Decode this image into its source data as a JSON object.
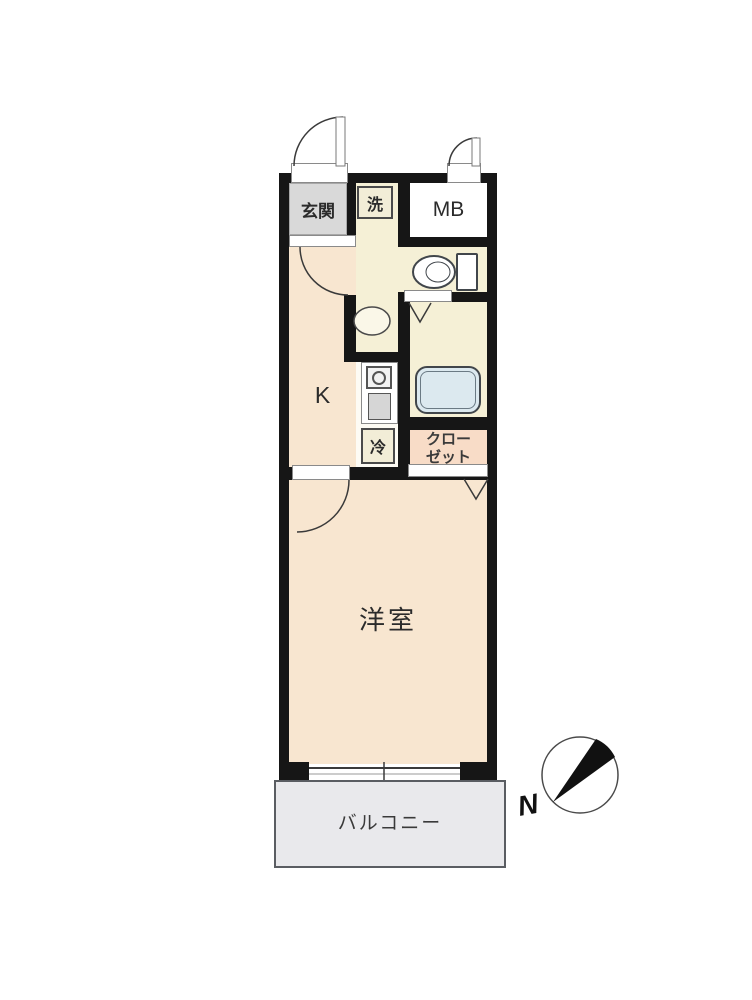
{
  "floorplan": {
    "type": "apartment-1K-floor-plan",
    "rooms": {
      "genkan": {
        "label": "玄関"
      },
      "laundry": {
        "label": "洗"
      },
      "meter_box": {
        "label": "MB"
      },
      "kitchen": {
        "label": "K"
      },
      "refrigerator": {
        "label": "冷"
      },
      "closet": {
        "label_line1": "クロー",
        "label_line2": "ゼット"
      },
      "western_room": {
        "label": "洋室"
      },
      "balcony": {
        "label": "バルコニー"
      }
    },
    "fixtures": [
      "entrance-door",
      "mb-door",
      "kitchen-door",
      "room-door",
      "toilet",
      "wash-basin",
      "bathtub",
      "stove",
      "kitchen-sink",
      "bathroom-folding-door",
      "closet-folding-door",
      "sliding-window"
    ],
    "compass": {
      "label": "N"
    },
    "colors": {
      "wall": "#161616",
      "room_peach": "#f8e6d0",
      "corridor_cream": "#f5f0d6",
      "closet_pink": "#f8dcc7",
      "genkan_gray": "#d9d9d9",
      "balcony_gray": "#e9e9ec",
      "bathtub_blue": "#dce9ef",
      "sink_gray": "#d6d6d6",
      "line": "#3a3a3a"
    }
  }
}
